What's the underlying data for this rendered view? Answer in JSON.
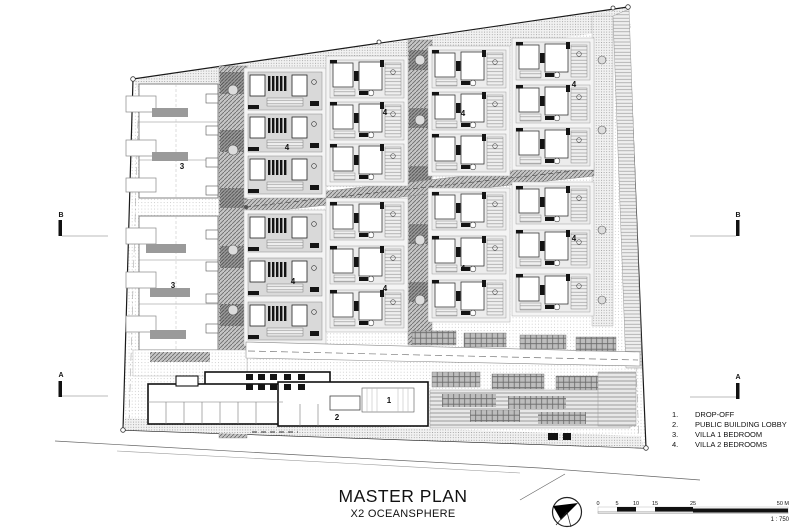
{
  "title": {
    "main": "MASTER PLAN",
    "sub": "X2 OCEANSPHERE"
  },
  "legend": {
    "items": [
      {
        "num": "1.",
        "label": "DROP-OFF"
      },
      {
        "num": "2.",
        "label": "PUBLIC BUILDING LOBBY"
      },
      {
        "num": "3.",
        "label": "VILLA 1 BEDROOM"
      },
      {
        "num": "4.",
        "label": "VILLA 2 BEDROOMS"
      }
    ]
  },
  "plan": {
    "unit_labels": {
      "villa1": "3",
      "villa2": "4",
      "dropoff": "1",
      "lobby": "2"
    },
    "sections": {
      "a": "A",
      "b": "B"
    }
  },
  "scalebar": {
    "ticks": [
      "0",
      "5",
      "10",
      "15",
      "25",
      "50 M"
    ],
    "ratio": "1 : 750"
  },
  "colors": {
    "ink": "#111111",
    "hatch": "#666666",
    "paper": "#ffffff"
  }
}
